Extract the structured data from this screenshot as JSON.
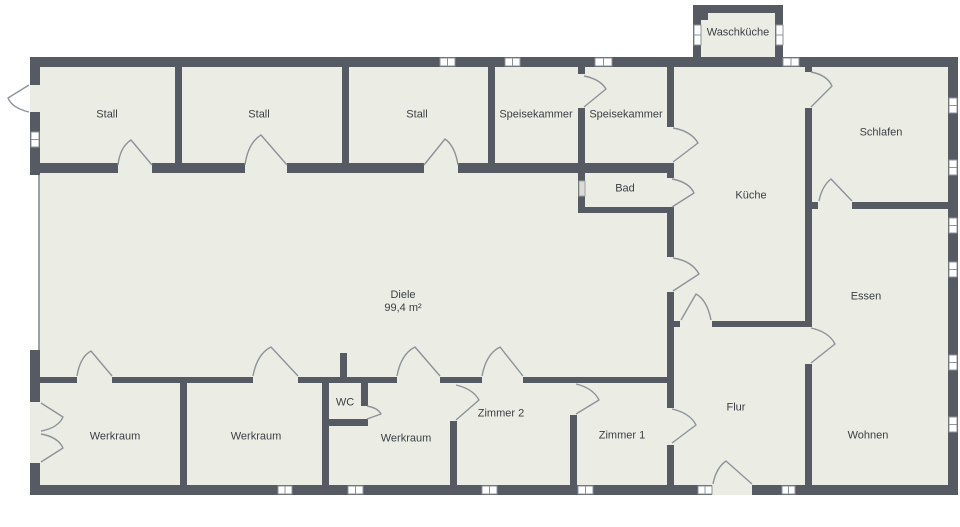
{
  "floor_plan": {
    "rooms": {
      "waschkueche": "Waschküche",
      "stall_1": "Stall",
      "stall_2": "Stall",
      "stall_3": "Stall",
      "speisekammer_1": "Speisekammer",
      "speisekammer_2": "Speisekammer",
      "schlafen": "Schlafen",
      "bad": "Bad",
      "kueche": "Küche",
      "diele": "Diele",
      "diele_area": "99,4 m²",
      "essen": "Essen",
      "werkraum_1": "Werkraum",
      "werkraum_2": "Werkraum",
      "werkraum_3": "Werkraum",
      "wc": "WC",
      "zimmer_2": "Zimmer 2",
      "zimmer_1": "Zimmer 1",
      "flur": "Flur",
      "wohnen": "Wohnen"
    },
    "colors": {
      "wall": "#565b63",
      "room_fill": "#ebece3",
      "outline": "#8d939b",
      "text": "#3b4046",
      "window": "#ffffff",
      "background": "#ffffff"
    }
  }
}
